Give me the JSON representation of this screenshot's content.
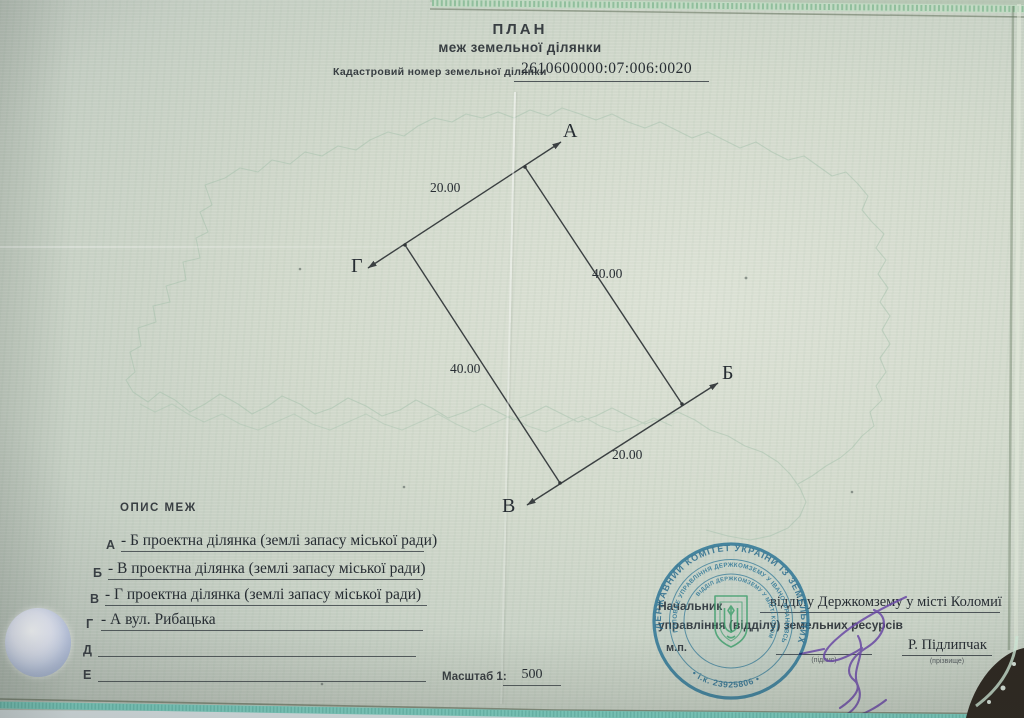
{
  "document": {
    "title_line1": "ПЛАН",
    "title_line2": "меж земельної ділянки",
    "cadastral_label": "Кадастровий номер земельної ділянки",
    "cadastral_number": "2610600000:07:006:0020"
  },
  "plan_diagram": {
    "vertex_labels": [
      "А",
      "Б",
      "В",
      "Г"
    ],
    "dimensions": {
      "side_ga": "20.00",
      "side_ab": "40.00",
      "side_vg": "40.00",
      "side_bv": "20.00"
    }
  },
  "boundaries": {
    "heading": "ОПИС МЕЖ",
    "rows": [
      {
        "letter": "А",
        "text": "- Б проектна ділянка (землі запасу міської ради)"
      },
      {
        "letter": "Б",
        "text": "- В проектна ділянка (землі запасу міської ради)"
      },
      {
        "letter": "В",
        "text": "- Г проектна ділянка (землі запасу міської ради)"
      },
      {
        "letter": "Г",
        "text": "- А вул. Рибацька"
      },
      {
        "letter": "Д",
        "text": ""
      },
      {
        "letter": "Е",
        "text": ""
      }
    ]
  },
  "scale": {
    "label": "Масштаб 1:",
    "value": "500"
  },
  "approval": {
    "position_title": "Начальник",
    "office_typed": "відділу Держкомзему у місті Коломиї",
    "position_line2": "управління (відділу) земельних ресурсів",
    "seal_mark": "м.п.",
    "signature_caption": "(підпис)",
    "surname": "Р. Підлипчак",
    "surname_caption": "(прізвище)"
  },
  "stamp": {
    "outer_ring": "ДЕРЖАВНИЙ КОМІТЕТ УКРАЇНИ ІЗ ЗЕМЕЛЬНИХ РЕСУРСІВ",
    "bottom_code": "• і.к. 23925806 •",
    "middle_ring": "ГОЛОВНЕ УПРАВЛІННЯ ДЕРЖКОМЗЕМУ У ІВАНО-ФРАНКІВСЬКІЙ ОБЛАСТІ",
    "inner_ring": "ВІДДІЛ ДЕРЖКОМЗЕМУ У МІСТІ КОЛОМИЇ",
    "emblem": "ukraine-trident-icon",
    "ink_color": "#2b7495",
    "emblem_color": "#3f9e6d"
  },
  "colors": {
    "paper": "#ccd4c9",
    "ink": "#2e3438",
    "signature": "#6a48a6",
    "sleeve_teal": "#7fd0c4"
  }
}
